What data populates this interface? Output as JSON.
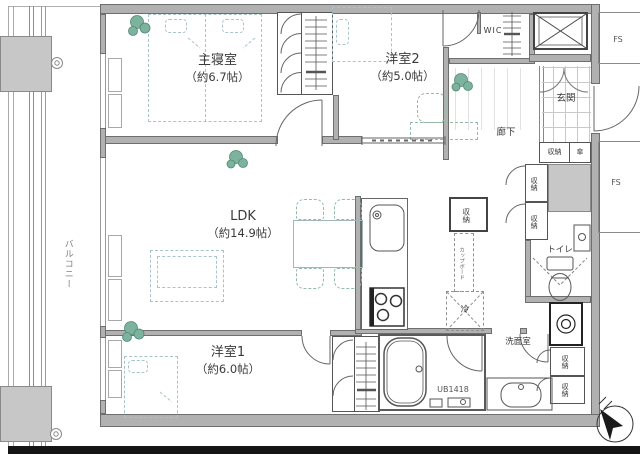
{
  "rooms": {
    "master_bedroom": {
      "label": "主寝室",
      "size": "（約6.7帖）"
    },
    "western_room_2": {
      "label": "洋室2",
      "size": "（約5.0帖）"
    },
    "ldk": {
      "label": "LDK",
      "size": "（約14.9帖）"
    },
    "western_room_1": {
      "label": "洋室1",
      "size": "（約6.0帖）"
    },
    "balcony": {
      "label": "バルコニー"
    },
    "entrance": {
      "label": "玄関"
    },
    "hallway": {
      "label": "廊下"
    },
    "toilet": {
      "label": "トイレ"
    },
    "washroom": {
      "label": "洗面室"
    },
    "walk_in_closet": {
      "label": "WIC"
    },
    "unit_bath": {
      "label": "UB1418"
    }
  },
  "fixtures": {
    "storage": "収納",
    "umbrella": "傘",
    "cupboard": "カップボード",
    "refrigerator": "冷",
    "floor_shaft": "FS"
  },
  "colors": {
    "wall": "#b1b1b1",
    "plant_green": "#7db39e",
    "furniture_dash_blue": "#a8c4ca",
    "furniture_dash_green": "#93bba6",
    "bottom_bar": "#151515"
  }
}
